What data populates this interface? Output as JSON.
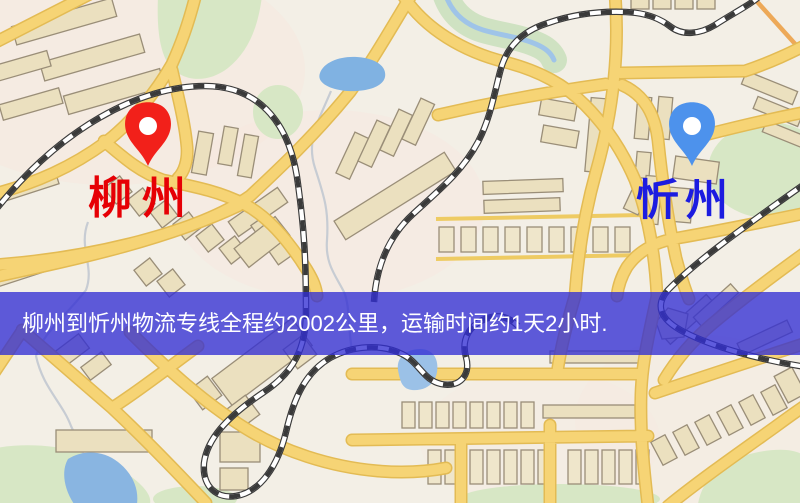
{
  "map": {
    "kind": "stylized street map",
    "zones": {
      "park_color": "#d7e7c5",
      "water_color": "#85b3e1",
      "road_color": "#f6d475",
      "railway_color": "#3a3a3a",
      "building_color": "#ebe0bf"
    }
  },
  "markers": {
    "origin": {
      "label": "柳州",
      "pin_color": "#f2201a",
      "label_color": "#e60005"
    },
    "destination": {
      "label": "忻州",
      "pin_color": "#4d92ec",
      "label_color": "#1c1ce0"
    }
  },
  "banner": {
    "text": "柳州到忻州物流专线全程约2002公里，运输时间约1天2小时.",
    "background_color": "rgba(50,46,212,0.78)",
    "text_color": "#ffffff"
  },
  "route": {
    "origin": "柳州",
    "destination": "忻州",
    "distance_text": "约2002公里",
    "duration_text": "约1天2小时"
  }
}
